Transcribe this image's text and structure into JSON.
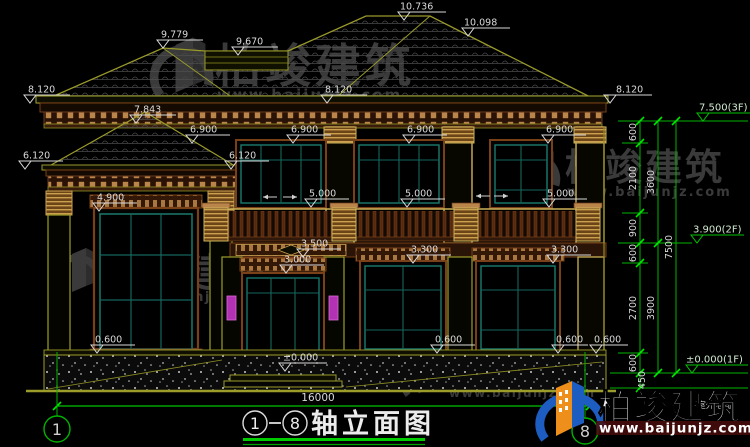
{
  "drawing": {
    "title": {
      "axis_from": "1",
      "axis_to": "8",
      "name": "轴立面图"
    },
    "axes": {
      "left": "1",
      "right": "8"
    },
    "levels": {
      "v10736": "10.736",
      "v10098": "10.098",
      "v9779": "9.779",
      "v9670": "9.670",
      "v8120_left": "8.120",
      "v8120_mid": "8.120",
      "v8120_right": "8.120",
      "v7843": "7.843",
      "v7500_3f": "7.500(3F)",
      "v6900_1": "6.900",
      "v6900_2": "6.900",
      "v6900_3": "6.900",
      "v6900_4": "6.900",
      "v6120_left": "6.120",
      "v6120_right": "6.120",
      "v5000_1": "5.000",
      "v5000_2": "5.000",
      "v5000_3": "5.000",
      "v4900": "4.900",
      "v3900_2f": "3.900(2F)",
      "v3500": "3.500",
      "v3300_1": "3.300",
      "v3300_2": "3.300",
      "v3000": "3.000",
      "v0600_1": "0.600",
      "v0600_2": "0.600",
      "v0600_3": "0.600",
      "v0600_4": "0.600",
      "v0000": "±0.000",
      "v0000_1f": "±0.000(1F)",
      "ground_note": "(室外地面)"
    },
    "dims": {
      "total_width": "16000",
      "c600a": "600",
      "c2100": "2100",
      "c900": "900",
      "c600b": "600",
      "c2700": "2700",
      "c600c": "600",
      "c3600": "3600",
      "c3900": "3900",
      "c7500": "7500",
      "c450": "450"
    }
  },
  "watermark": {
    "brand": "柏竣建筑",
    "url": "www.baijunjz.com"
  },
  "colors": {
    "background": "#000000",
    "cad_line": "#9c9c2a",
    "dim_green": "#00d400",
    "text_gray": "#d9d9d9",
    "window_teal": "#1a7a6e",
    "trim_brown": "#7a4018",
    "dentil_tan": "#b9854a",
    "lamp_magenta": "#b332b3",
    "logo_blue": "#1d5cc0",
    "logo_orange": "#ee8f1c"
  }
}
